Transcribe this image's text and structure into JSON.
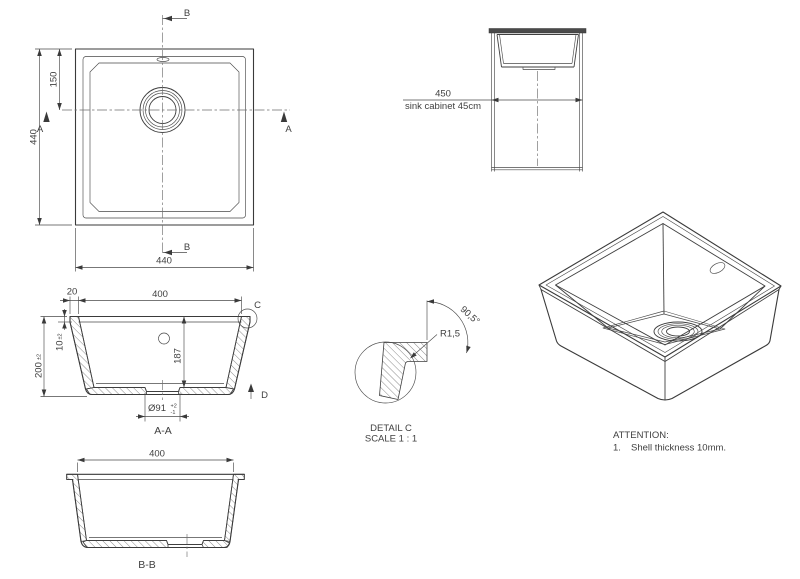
{
  "drawing": {
    "top_view": {
      "dim_height": "440",
      "dim_width_bottom": "440",
      "dim_drain_from_top": "150",
      "section_a_left": "A",
      "section_a_right": "A",
      "section_b_top": "B",
      "section_b_bottom": "B"
    },
    "cabinet_view": {
      "dim": "450",
      "label": "sink cabinet 45cm"
    },
    "section_aa": {
      "title": "A-A",
      "dim_rim": "20",
      "dim_inner_width": "400",
      "dim_rim_height": "10",
      "dim_rim_height_tol": "±2",
      "dim_depth": "200",
      "dim_depth_tol": "±2",
      "dim_inner_depth": "187",
      "dim_drain": "Ø91",
      "drain_tol_plus": "+2",
      "drain_tol_minus": "-1",
      "detail_label": "C",
      "arrow_label": "D"
    },
    "detail_c": {
      "radius": "R1,5",
      "angle": "90,5°",
      "title": "DETAIL C",
      "scale": "SCALE 1 : 1"
    },
    "section_bb": {
      "title": "B-B",
      "dim_inner_width": "400"
    },
    "attention": {
      "heading": "ATTENTION:",
      "item_number": "1.",
      "item_text": "Shell thickness 10mm."
    }
  },
  "colors": {
    "line": "#3a3a3a",
    "text": "#3f3f3f",
    "background": "#ffffff",
    "countertop_fill": "#4a4a4a"
  }
}
